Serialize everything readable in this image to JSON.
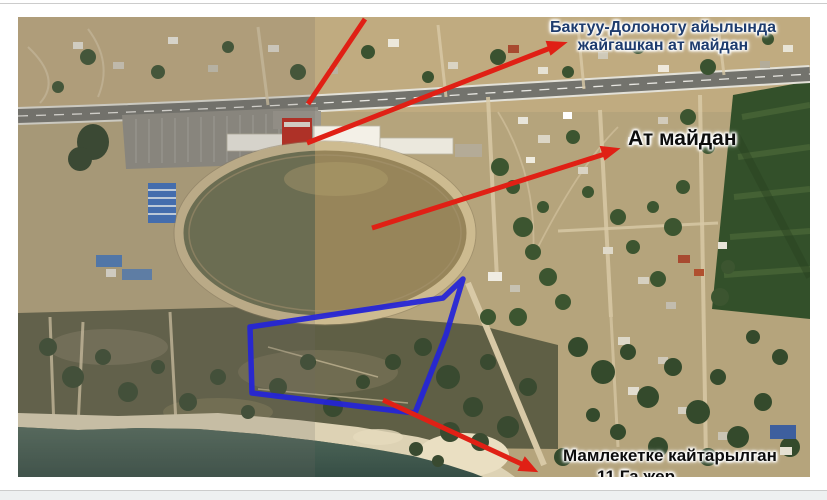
{
  "map": {
    "type": "annotated-satellite-image",
    "features": [
      "highway",
      "hippodrome-racetrack",
      "stables",
      "grandstand",
      "village",
      "green-field",
      "scrubland",
      "beach",
      "lake-shore"
    ]
  },
  "labels": {
    "top_right": {
      "line1": "Бактуу-Долоноту айылында",
      "line2": "жайгашкан ат майдан",
      "color": "#1e3c6e"
    },
    "at_maidan": {
      "text": "Ат майдан",
      "color": "#0d0d0d"
    },
    "bottom": {
      "line1": "Мамлекетке кайтарылган",
      "line2_partial": "11 Га жер",
      "color": "#0d0d0d"
    }
  },
  "annotations": {
    "arrow_color": "#e02015",
    "parcel_outline_color": "#2424d8",
    "arrows": [
      {
        "name": "arrow-top-left",
        "points_to": "top edge (clipped)"
      },
      {
        "name": "arrow-to-village-title",
        "points_to": "Бактуу-Долоноту айылында жайгашкан ат майдан"
      },
      {
        "name": "arrow-to-at-maidan",
        "points_to": "Ат майдан"
      },
      {
        "name": "arrow-to-returned-land",
        "points_to": "Мамлекетке кайтарылган"
      }
    ]
  }
}
